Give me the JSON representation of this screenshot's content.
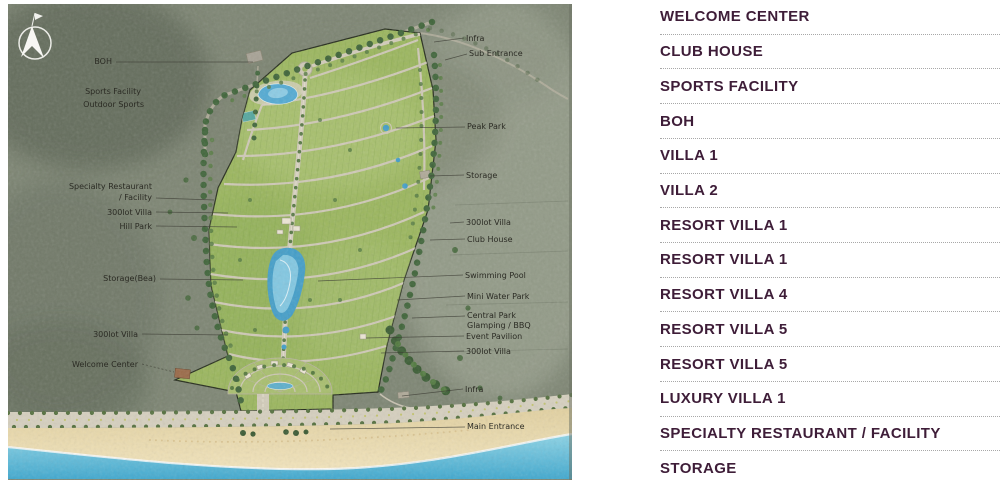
{
  "legend": {
    "items": [
      "WELCOME CENTER",
      "CLUB HOUSE",
      "SPORTS FACILITY",
      "BOH",
      "VILLA 1",
      "VILLA 2",
      "RESORT VILLA 1",
      "RESORT VILLA 1",
      "RESORT VILLA 4",
      "RESORT VILLA 5",
      "RESORT VILLA 5",
      "LUXURY VILLA 1",
      "SPECIALTY RESTAURANT / FACILITY",
      "STORAGE"
    ]
  },
  "map": {
    "compass": "N",
    "left_labels": [
      "BOH",
      "Sports Facility",
      "Outdoor Sports",
      "Specialty Restaurant",
      "/ Facility",
      "300lot Villa",
      "Hill Park",
      "Storage(Bea)",
      "300lot Villa",
      "Welcome Center"
    ],
    "right_labels": [
      "Infra",
      "Sub Entrance",
      "Peak Park",
      "Storage",
      "300lot Villa",
      "Club House",
      "Swimming Pool",
      "Mini Water Park",
      "Central Park",
      "Glamping / BBQ",
      "Event Pavilion",
      "300lot Villa",
      "Infra",
      "Main Entrance"
    ],
    "colors": {
      "terrain": "#7e8674",
      "site_green": "#9cb75f",
      "road": "#d0cab8",
      "tree": "#40653a",
      "water": "#459fc9",
      "ocean": "#41a9cf",
      "sand": "#ead8a9",
      "legend_text": "#3e1d38"
    }
  }
}
